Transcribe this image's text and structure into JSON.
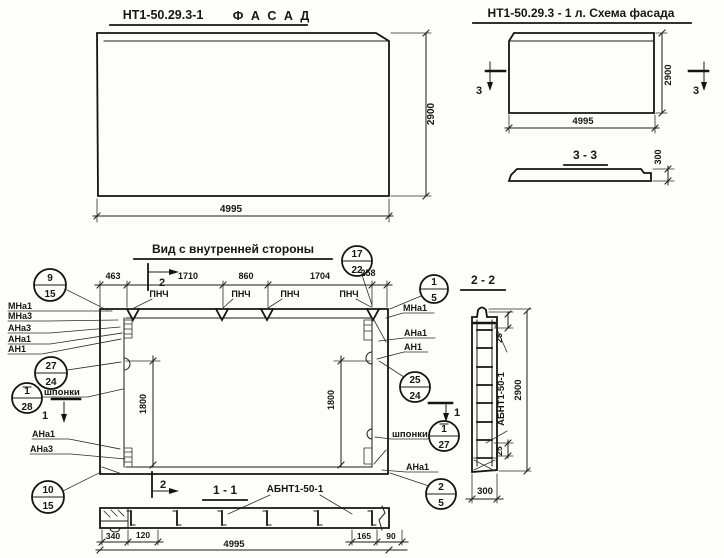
{
  "facade": {
    "title_code": "НТ1-50.29.3-1",
    "title_word": "Ф А С А Д",
    "dim_width": "4995",
    "dim_height": "2900"
  },
  "scheme": {
    "title": "НТ1-50.29.3 - 1 л. Схема фасада",
    "dim_width": "4995",
    "dim_height": "2900",
    "section_mark": "3"
  },
  "section33": {
    "title": "3 - 3",
    "dim_thickness": "300"
  },
  "inner": {
    "title": "Вид с внутренней стороны",
    "top_dims": [
      "463",
      "1710",
      "860",
      "1704",
      "258"
    ],
    "loop_label": "ПНЧ",
    "dim_vertical": "1800",
    "labels": {
      "mna1": "МНа1",
      "mna3": "МНа3",
      "ana3": "АНа3",
      "ana1": "АНа1",
      "an1": "АН1",
      "keys": "шпонки"
    },
    "section1_mark": "1",
    "section2_mark": "2",
    "callouts": [
      {
        "id": "9-15",
        "top": "9",
        "bottom": "15"
      },
      {
        "id": "27-24",
        "top": "27",
        "bottom": "24"
      },
      {
        "id": "1-28",
        "top": "1",
        "bottom": "28"
      },
      {
        "id": "10-15",
        "top": "10",
        "bottom": "15"
      },
      {
        "id": "17-22",
        "top": "17",
        "bottom": "22"
      },
      {
        "id": "1-5",
        "top": "1",
        "bottom": "5"
      },
      {
        "id": "25-24",
        "top": "25",
        "bottom": "24"
      },
      {
        "id": "1-27",
        "top": "1",
        "bottom": "27"
      },
      {
        "id": "2-5",
        "top": "2",
        "bottom": "5"
      }
    ]
  },
  "section22": {
    "title": "2 - 2",
    "part_label": "АБНТ1-50-1",
    "dim_top": "25",
    "dim_bottom": "25",
    "dim_height": "2900",
    "dim_width": "300"
  },
  "section11": {
    "title": "1 - 1",
    "part_label": "АБНТ1-50-1",
    "dim_a": "340",
    "dim_b": "120",
    "dim_total": "4995",
    "dim_c": "165",
    "dim_d": "90"
  }
}
